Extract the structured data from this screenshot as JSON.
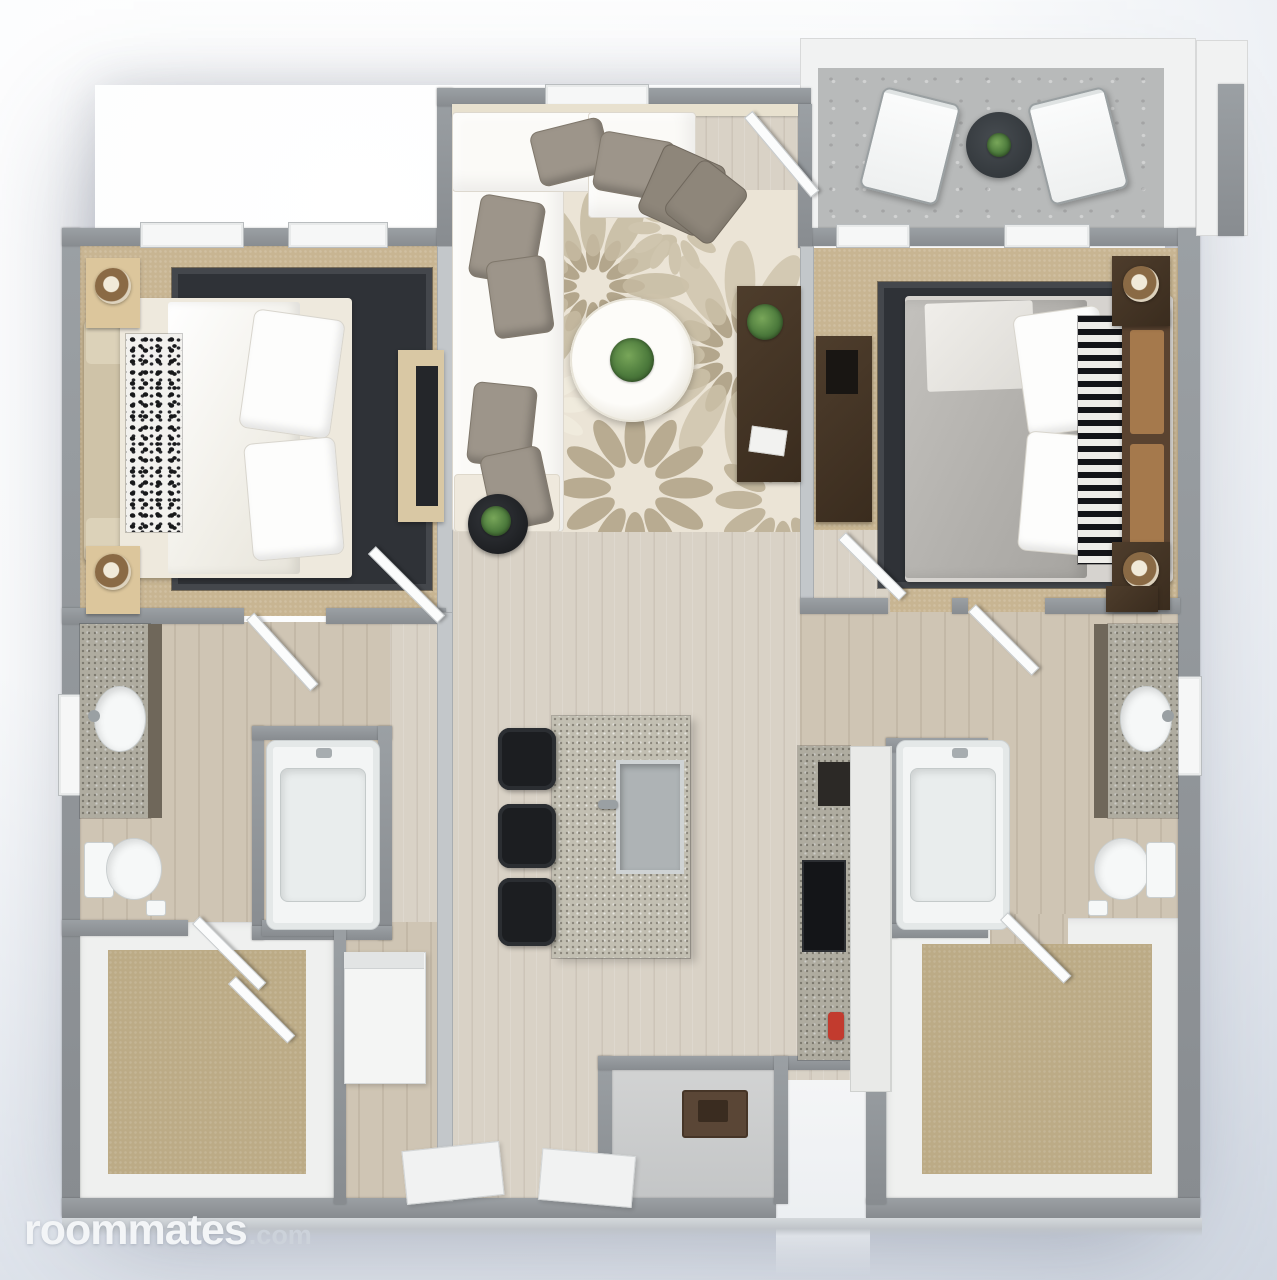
{
  "watermark": {
    "brand": "roommates",
    "tld": ".com"
  },
  "palette": {
    "background_top": "#ffffff",
    "background_bottom": "#c9d1dd",
    "wall_gray": "#8e9296",
    "wood_floor": "#d9d2c6",
    "bedroom_carpet": "#c8b592",
    "closet_carpet": "#bcab86",
    "balcony_concrete": "#b8baba",
    "area_rug_base": "#ebe4d6",
    "area_rug_petal": "#b5a88e",
    "bedroom_rug": "#2f3237",
    "granite_counter": "#c2bfb2",
    "dark_wood_furniture": "#463728",
    "black_furniture": "#1c1e21",
    "white_fixture": "#f3f5f5",
    "plant_green": "#4c7a3c",
    "accent_red": "#c23b2e"
  }
}
